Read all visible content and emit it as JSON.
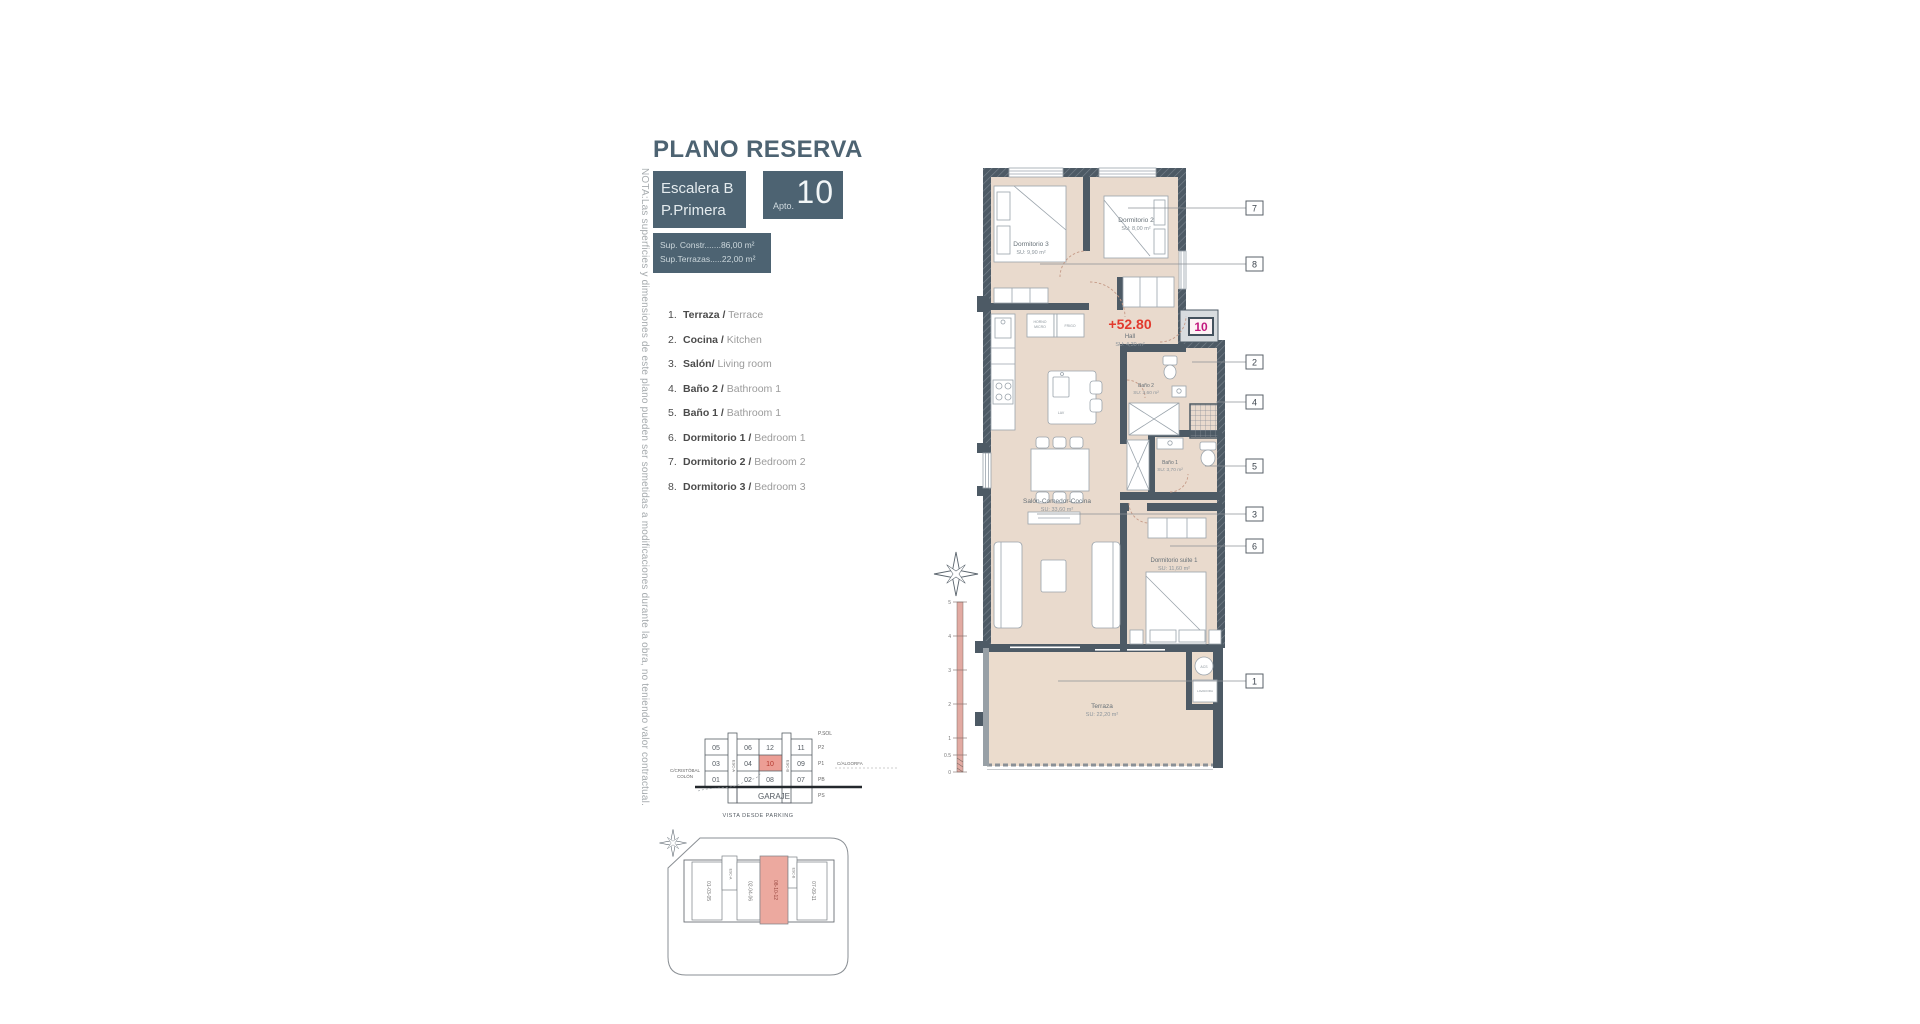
{
  "header": {
    "title": "PLANO RESERVA",
    "stair_line1": "Escalera B",
    "stair_line2": "P.Primera",
    "apto_label": "Apto.",
    "apto_number": "10",
    "sup_constr": "Sup. Constr.......86,00 m²",
    "sup_terrazas": "Sup.Terrazas.....22,00 m²"
  },
  "note": "NOTA:Las superficies y dimensiones de este plano pueden ser sometidas a modificaciones durante la obra, no teniendo valor contractual.",
  "legend": {
    "items": [
      {
        "num": "1.",
        "es": "Terraza /",
        "en": "Terrace"
      },
      {
        "num": "2.",
        "es": "Cocina /",
        "en": "Kitchen"
      },
      {
        "num": "3.",
        "es": "Salón/",
        "en": "Living room"
      },
      {
        "num": "4.",
        "es": "Baño 2 /",
        "en": "Bathroom 1"
      },
      {
        "num": "5.",
        "es": "Baño 1 /",
        "en": "Bathroom 1"
      },
      {
        "num": "6.",
        "es": "Dormitorio 1 /",
        "en": "Bedroom 1"
      },
      {
        "num": "7.",
        "es": "Dormitorio 2 /",
        "en": "Bedroom 2"
      },
      {
        "num": "8.",
        "es": "Dormitorio 3 /",
        "en": "Bedroom 3"
      }
    ]
  },
  "plan": {
    "level_value": "+52.80",
    "unit_badge": "10",
    "rooms": [
      {
        "name": "Dormitorio 3",
        "area": "SU: 9,90 m²"
      },
      {
        "name": "Dormitorio 2",
        "area": "SU: 8,00 m²"
      },
      {
        "name": "Hall",
        "area": "SU: 4,30 m²"
      },
      {
        "name": "Baño 2",
        "area": "SU: 3,60 m²"
      },
      {
        "name": "Baño 1",
        "area": "SU: 3,70 m²"
      },
      {
        "name": "Salón-Comedor-Cocina",
        "area": "SU: 33,60 m²"
      },
      {
        "name": "Dormitorio suite 1",
        "area": "SU: 11,60 m²"
      },
      {
        "name": "Terraza",
        "area": "SU: 22,20 m²"
      }
    ],
    "labels": {
      "horno_l1": "HORNO",
      "horno_l2": "MICRO",
      "frigo": "FRIGO",
      "lav": "LAV",
      "acs": "ACS",
      "lavadora": "LAVADORA"
    },
    "callouts": [
      "7",
      "8",
      "2",
      "4",
      "5",
      "3",
      "6",
      "1"
    ],
    "scale_ticks": [
      "5",
      "4",
      "3",
      "2",
      "1",
      "0.5",
      "0"
    ]
  },
  "section": {
    "title": "VISTA DESDE PARKING",
    "garaje": "GARAJE",
    "psol": "P.SOL",
    "floor_labels": [
      "P2",
      "P1",
      "PB",
      "PS"
    ],
    "street_left_l1": "C/CRISTÓBAL",
    "street_left_l2": "COLÓN",
    "street_right": "C/ALGORFA",
    "esc_a": "ESC-A",
    "esc_b": "ESC-B",
    "rows": [
      [
        "05",
        "06",
        "12",
        "11"
      ],
      [
        "03",
        "04",
        "10",
        "09"
      ],
      [
        "01",
        "02",
        "08",
        "07"
      ]
    ],
    "highlight": "10"
  },
  "siteplan": {
    "blocks": [
      {
        "label": "01-03-05"
      },
      {
        "label": "ESC-A"
      },
      {
        "label": "02-04-06"
      },
      {
        "label": "08-10-12",
        "highlight": true
      },
      {
        "label": "ESC-B"
      },
      {
        "label": "07-09-11"
      }
    ]
  },
  "colors": {
    "header_slate": "#4d6372",
    "plan_beige": "#e9dacd",
    "wall": "#4d5a65",
    "highlight_pink": "#eca99f",
    "level_red": "#e23a2e",
    "unit_magenta": "#c2187e"
  }
}
